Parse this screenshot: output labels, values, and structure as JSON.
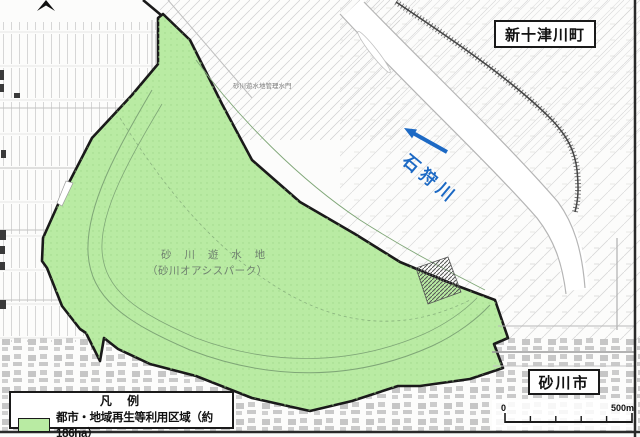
{
  "labels": {
    "town_top_right": "新十津川町",
    "city_bottom_right": "砂川市",
    "river_name": "石狩川",
    "site_name_line1": "砂 川 遊 水 地",
    "site_name_line2": "（砂川オアシスパーク）",
    "facility_small_label": "砂川遊水地管理水門"
  },
  "legend": {
    "title": "凡 例",
    "items": [
      {
        "swatch_color": "#b9eba3",
        "label": "都市・地域再生等利用区域（約186ha）"
      }
    ]
  },
  "scale_bar": {
    "start_label": "0",
    "end_label": "500m",
    "segments": 5
  },
  "icons": {
    "flow_arrow": "arrow-up-left",
    "north_arrow": "north-arrow-partial"
  },
  "colors": {
    "zone_fill": "#b9eba3",
    "zone_outline": "#1a1a1a",
    "river_annotation": "#1c69c4",
    "map_linework": "#c8c8c8"
  }
}
